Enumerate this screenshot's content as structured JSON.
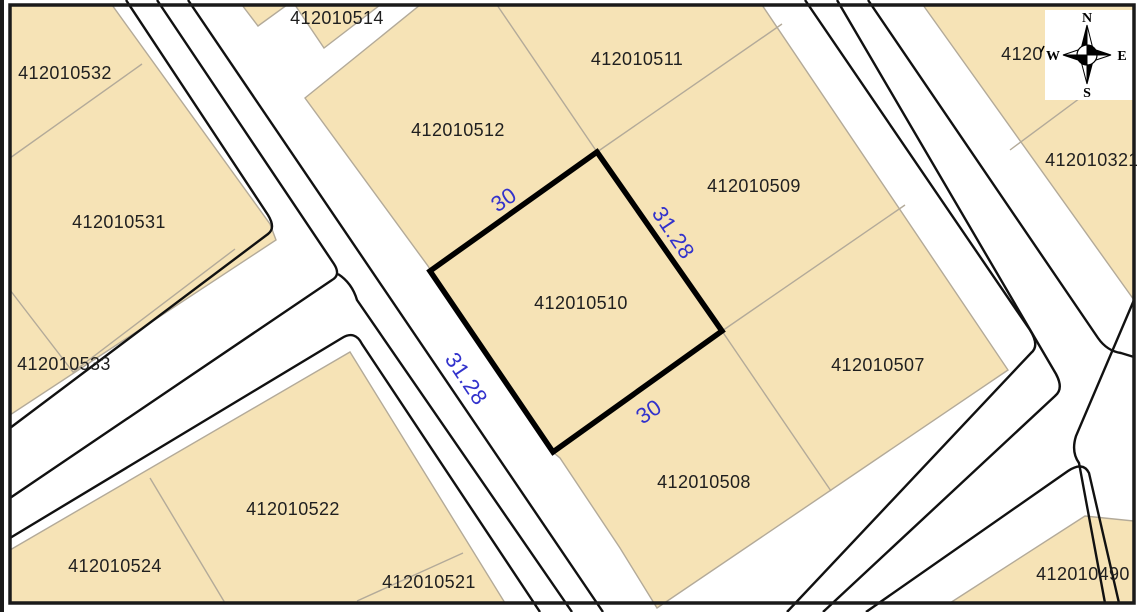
{
  "map": {
    "parcels": [
      {
        "id": "412010514"
      },
      {
        "id": "412010532"
      },
      {
        "id": "412010511"
      },
      {
        "id": "412010512"
      },
      {
        "id": "412010321"
      },
      {
        "id": "412010509"
      },
      {
        "id": "412010531"
      },
      {
        "id": "412010510"
      },
      {
        "id": "412010533"
      },
      {
        "id": "412010507"
      },
      {
        "id": "412010508"
      },
      {
        "id": "412010522"
      },
      {
        "id": "412010524"
      },
      {
        "id": "412010521"
      },
      {
        "id": "412010490"
      }
    ],
    "partial_parcel_label": "4120",
    "highlight": {
      "parcel_id": "412010510",
      "dimensions": [
        {
          "value": "30"
        },
        {
          "value": "31.28"
        },
        {
          "value": "31.28"
        },
        {
          "value": "30"
        }
      ]
    },
    "compass": {
      "north": "N",
      "east": "E",
      "south": "S",
      "west": "W"
    },
    "colors": {
      "parcel_fill": "#F6E3B6",
      "parcel_border": "#B3AA99",
      "road_line": "#111111",
      "highlight_border": "#000000",
      "dimension_text": "#3232CC",
      "label_text": "#1f1f1f",
      "frame": "#1a1a1a",
      "bg": "#FFFFFF"
    }
  }
}
